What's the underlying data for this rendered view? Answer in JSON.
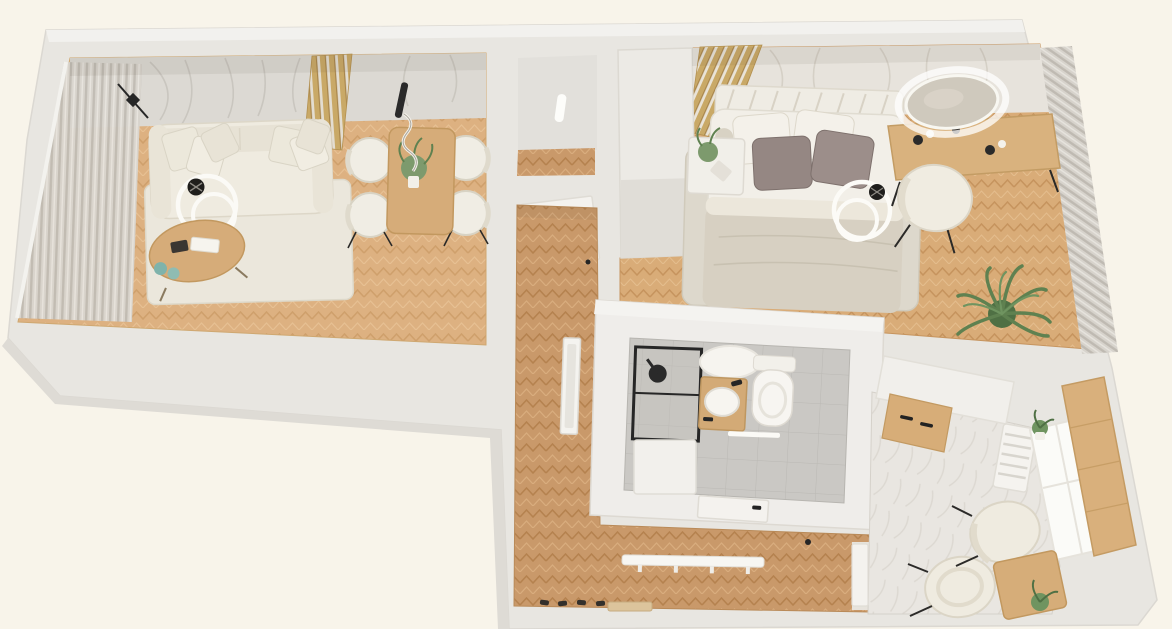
{
  "scene": {
    "title": "3D apartment floor plan render",
    "view": "top-down isometric",
    "background_color": "#f8f4ea",
    "wall_color": "#e8e6e1",
    "accent_wood_color": "#c9a967"
  },
  "palette": {
    "wall": "#e8e6e1",
    "wall_bright": "#f1efec",
    "floor_living": "#ddb181",
    "floor_hall": "#c9996a",
    "floor_bedroom": "#d9ac78",
    "floor_bathroom": "#cac8c4",
    "floor_kitchen": "#e9e6e1",
    "rug": "#ebe7dc",
    "sofa": "#efebe0",
    "wood_furniture": "#d6ac79",
    "pillow_taupe": "#958783",
    "plant_green": "#5f8150",
    "frame_black": "#262626"
  },
  "rooms": {
    "living": {
      "label": "Living room",
      "furniture": [
        "sofa with cushions",
        "ring floor lamp",
        "coffee table",
        "area rug",
        "dining table",
        "dining chairs",
        "pendant lamp",
        "curtains",
        "wood slat panel",
        "palm wallpaper",
        "wall lamp"
      ]
    },
    "niche": {
      "label": "Entry niche",
      "furniture": [
        "wall switch",
        "open door"
      ]
    },
    "hall": {
      "label": "Hallway",
      "furniture": [
        "standing mirror",
        "coat rack",
        "shoes",
        "doormat"
      ]
    },
    "bedroom": {
      "label": "Bedroom",
      "furniture": [
        "double bed",
        "headboard",
        "pillows",
        "nightstand with plant",
        "area rug",
        "vanity desk",
        "round illuminated mirror",
        "vanity chair",
        "curtains",
        "palm plant",
        "wardrobe",
        "wood slat panel",
        "ring decor lamp"
      ]
    },
    "bathroom": {
      "label": "Bathroom",
      "furniture": [
        "shower with black frame",
        "ceiling light",
        "wood vanity with basin",
        "toilet",
        "towel rail",
        "storage bench",
        "open door"
      ]
    },
    "kitchen": {
      "label": "Kitchen",
      "furniture": [
        "counter with wood cabinets",
        "radiator",
        "window",
        "wood counter panel",
        "two chairs",
        "small wood table",
        "potted plants"
      ]
    }
  }
}
